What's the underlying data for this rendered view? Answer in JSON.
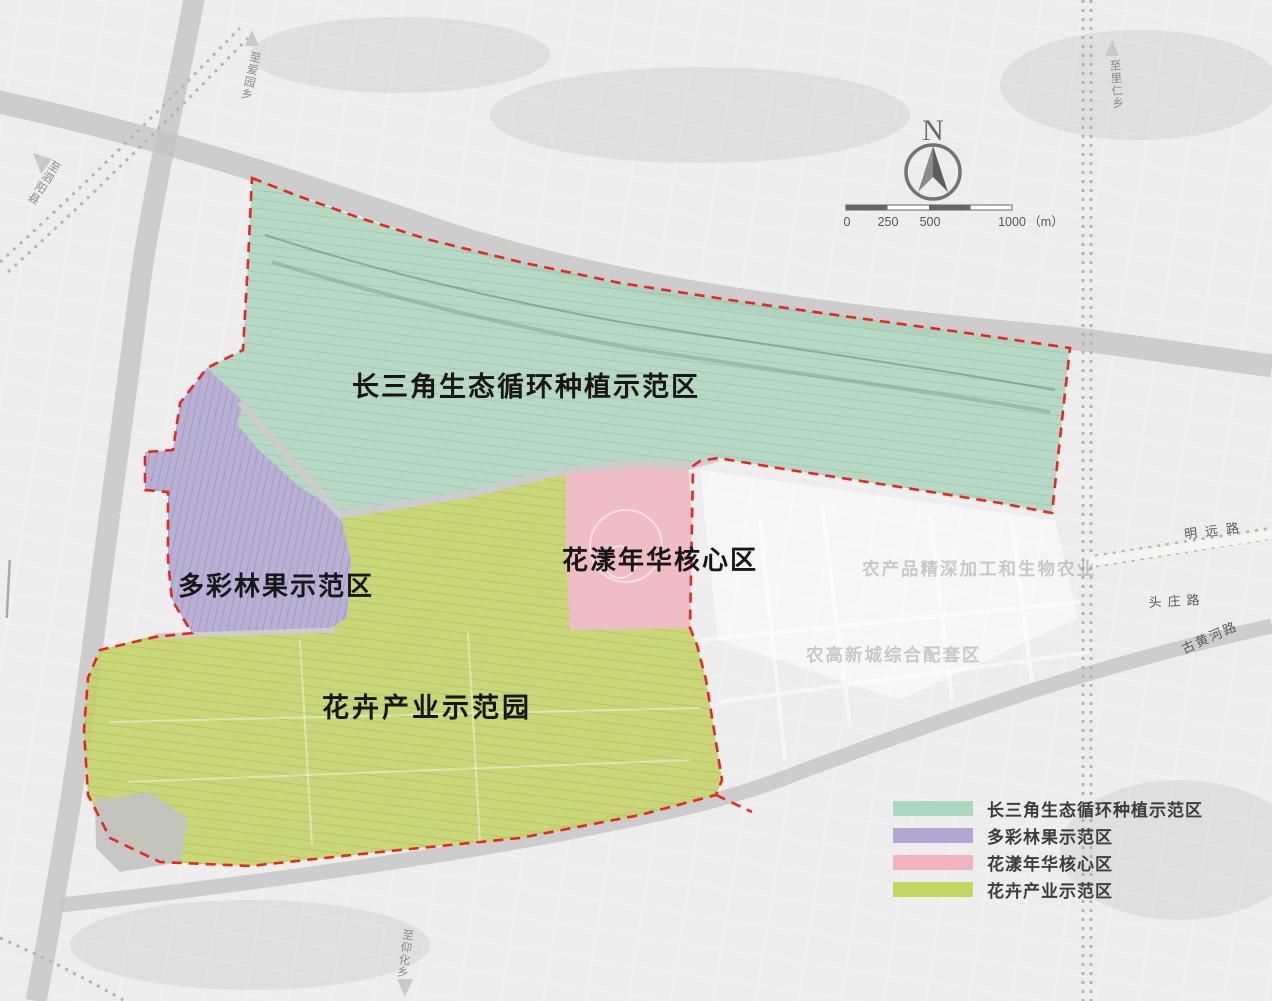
{
  "site": {
    "boundary_color": "#e8281e"
  },
  "zones": {
    "green": {
      "map_label": "长三角生态循环种植示范区",
      "color": "#a9d4bc"
    },
    "purple": {
      "map_label": "多彩林果示范区",
      "color": "#b0a5d2"
    },
    "pink": {
      "map_label": "花漾年华核心区",
      "color": "#eeb4bf"
    },
    "lime": {
      "map_label": "花卉产业示范园",
      "color": "#c3d264"
    }
  },
  "legend": {
    "items": [
      {
        "label": "长三角生态循环种植示范区",
        "color": "#abd8c0"
      },
      {
        "label": "多彩林果示范区",
        "color": "#b2a7d3"
      },
      {
        "label": "花漾年华核心区",
        "color": "#f0b4bf"
      },
      {
        "label": "花卉产业示范区",
        "color": "#c3d65f"
      }
    ]
  },
  "compass": {
    "label": "N"
  },
  "scalebar": {
    "tick0": "0",
    "tick250": "250",
    "tick500": "500",
    "tick1000": "1000",
    "unit": "（m）"
  },
  "roads": {
    "mingyuan": "明远路",
    "touzhuang": "头庄路",
    "guhuanghe": "古黄河路"
  },
  "directions": {
    "northwest": "至泗阳县",
    "north": "至爱园乡",
    "northeast": "至里仁乡",
    "south": "至仰化乡"
  },
  "background_texts": {
    "agri": "农产品精深加工和生物农业",
    "newtown": "农高新城综合配套区"
  }
}
